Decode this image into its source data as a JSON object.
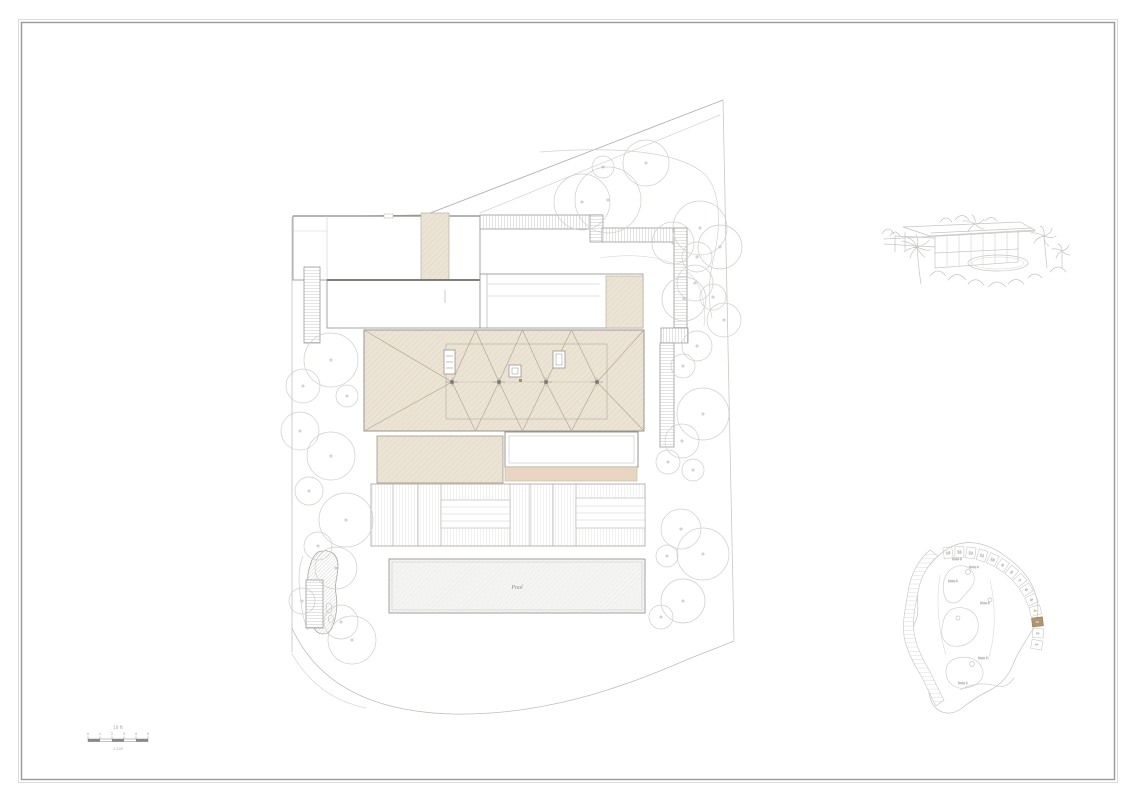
{
  "site_plan": {
    "pool_label": "Pool"
  },
  "scale_bar": {
    "title": "10 ft",
    "tick_labels": [
      "0",
      "1",
      "2",
      "3",
      "4",
      "5"
    ],
    "ratio_note": "1:200"
  },
  "key_map": {
    "plot_numbers": [
      "14",
      "13",
      "12",
      "11",
      "10",
      "9",
      "8",
      "7",
      "6",
      "5",
      "4",
      "3",
      "2",
      "1"
    ],
    "highlighted_plot": "3",
    "hole_labels": [
      "Hole 3",
      "Hole 4",
      "Hole 2",
      "Hole 5",
      "Hole 7",
      "Hole 1"
    ]
  },
  "colors": {
    "roof_beige": "#ebe3d4",
    "tan_accent": "#e9d6c2",
    "plot_highlight": "#b4936f",
    "frame_line": "#9a9a9a"
  }
}
